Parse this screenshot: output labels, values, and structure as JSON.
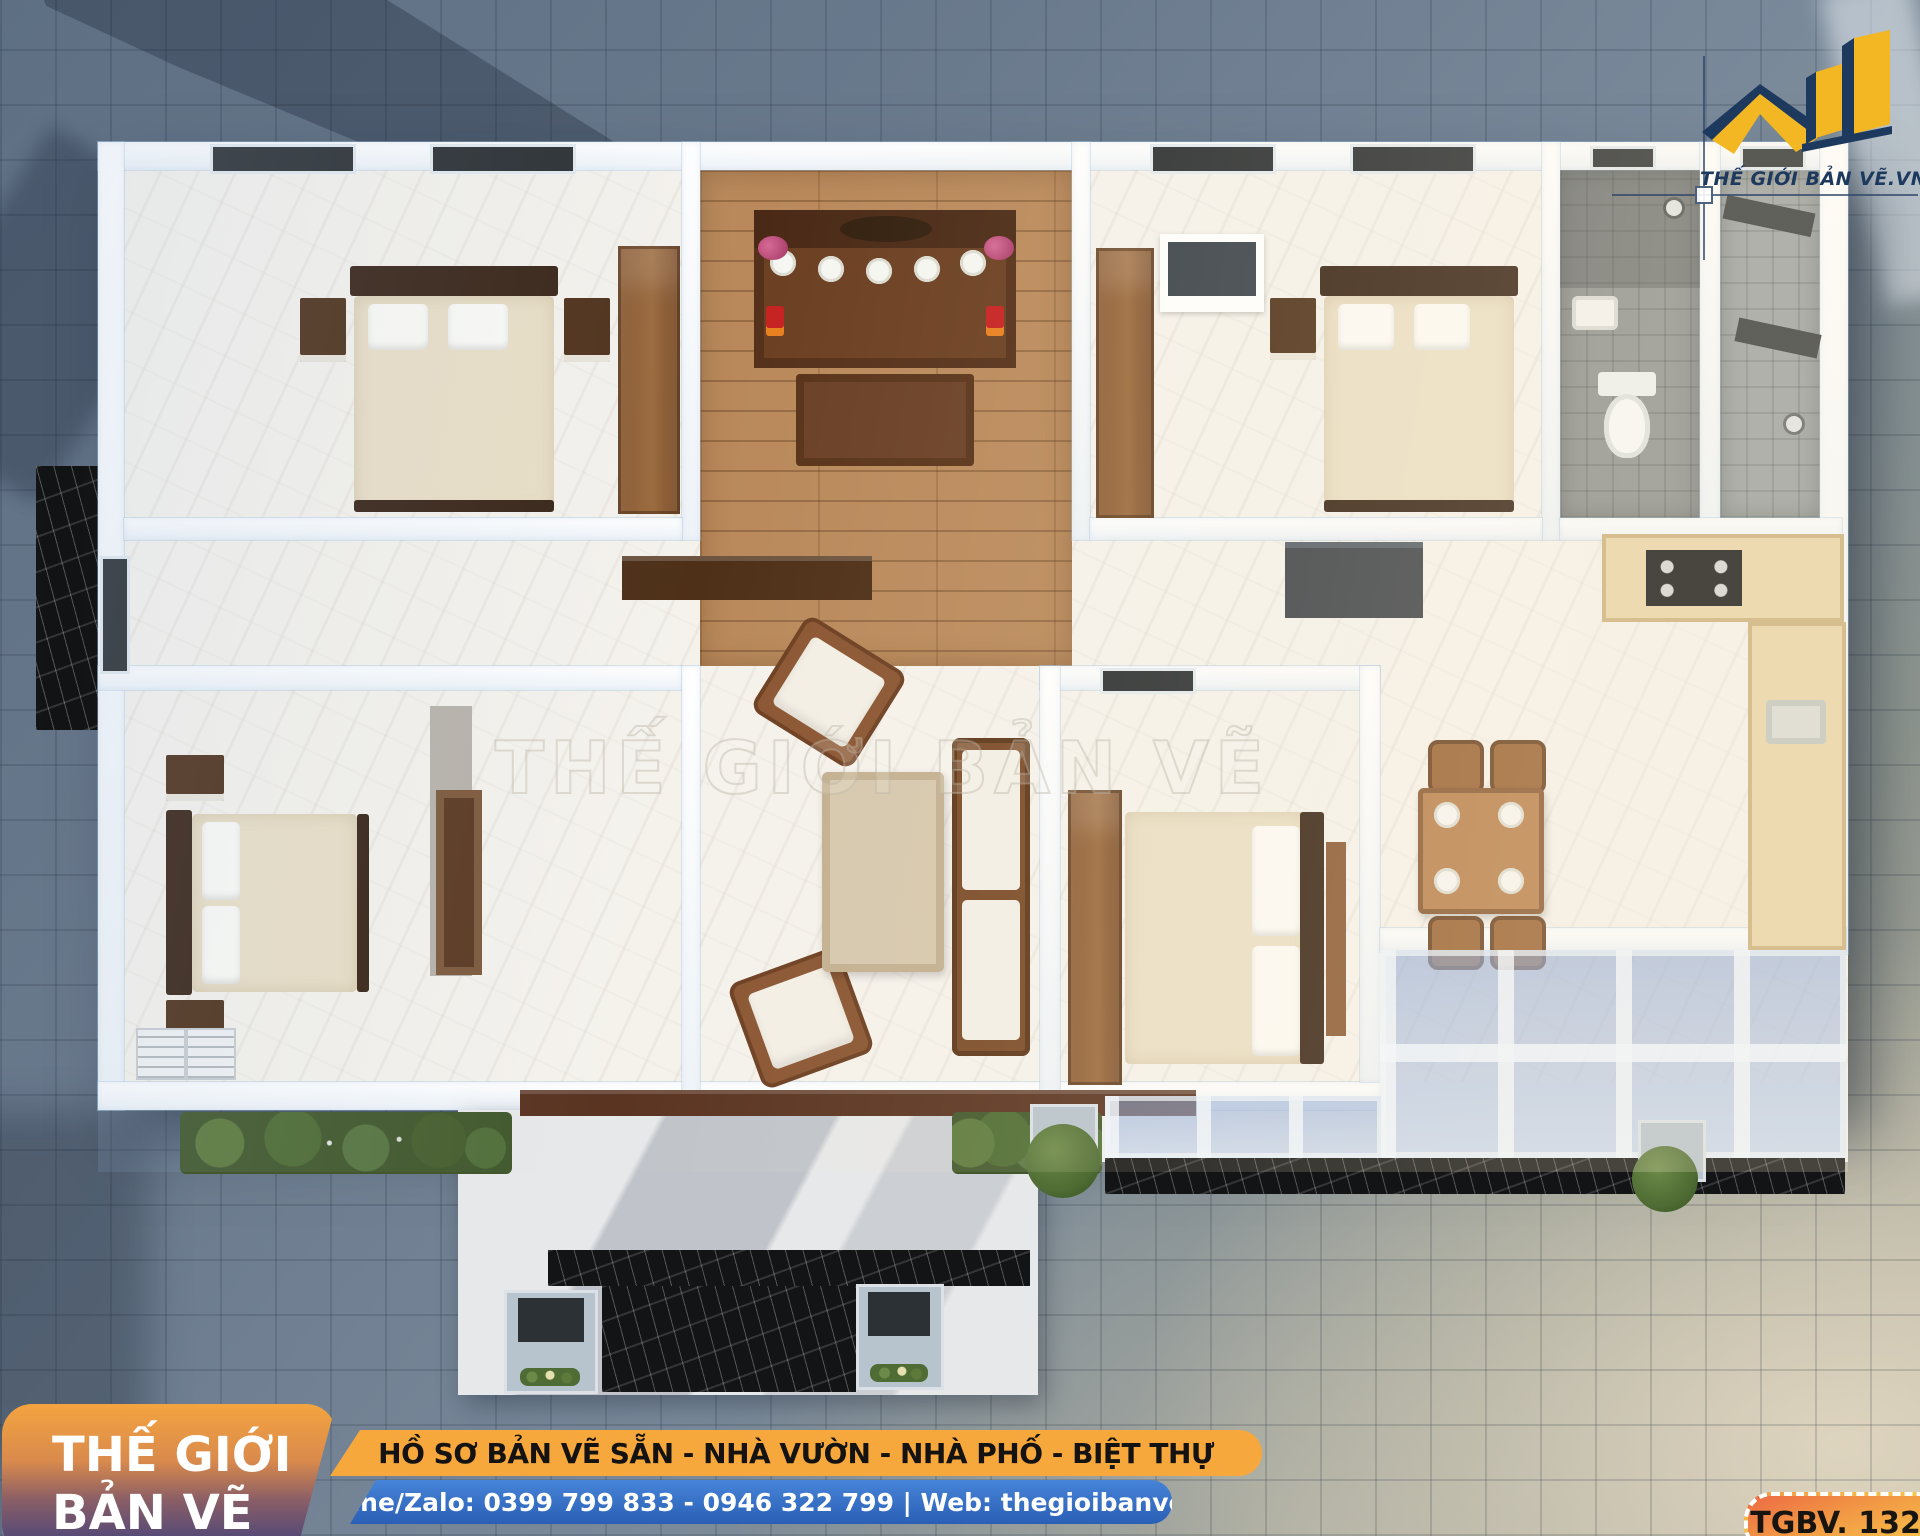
{
  "brand": {
    "logo_text": "THẾ GIỚI BẢN VẼ.VN",
    "watermark": "THẾ GIỚI BẢN VẼ",
    "colors": {
      "logo_yellow": "#F2B722",
      "logo_navy": "#1D3A5E"
    }
  },
  "footer": {
    "badge_line1": "THẾ GIỚI",
    "badge_line2": "BẢN VẼ",
    "services_banner": "HỒ SƠ BẢN VẼ SẴN - NHÀ VƯỜN - NHÀ PHỐ - BIỆT THỰ",
    "contact_banner": "Hotline/Zalo: 0399 799 833 - 0946 322 799 | Web: thegioibanve.vn",
    "design_code": "TGBV. 1321",
    "colors": {
      "services_bg": "#F6A83C",
      "contact_bg": "#2F6FC8",
      "badge_gradient_top": "#F4A43F",
      "badge_gradient_bottom": "#3F417E",
      "code_badge_border": "#FFFFFF"
    }
  }
}
